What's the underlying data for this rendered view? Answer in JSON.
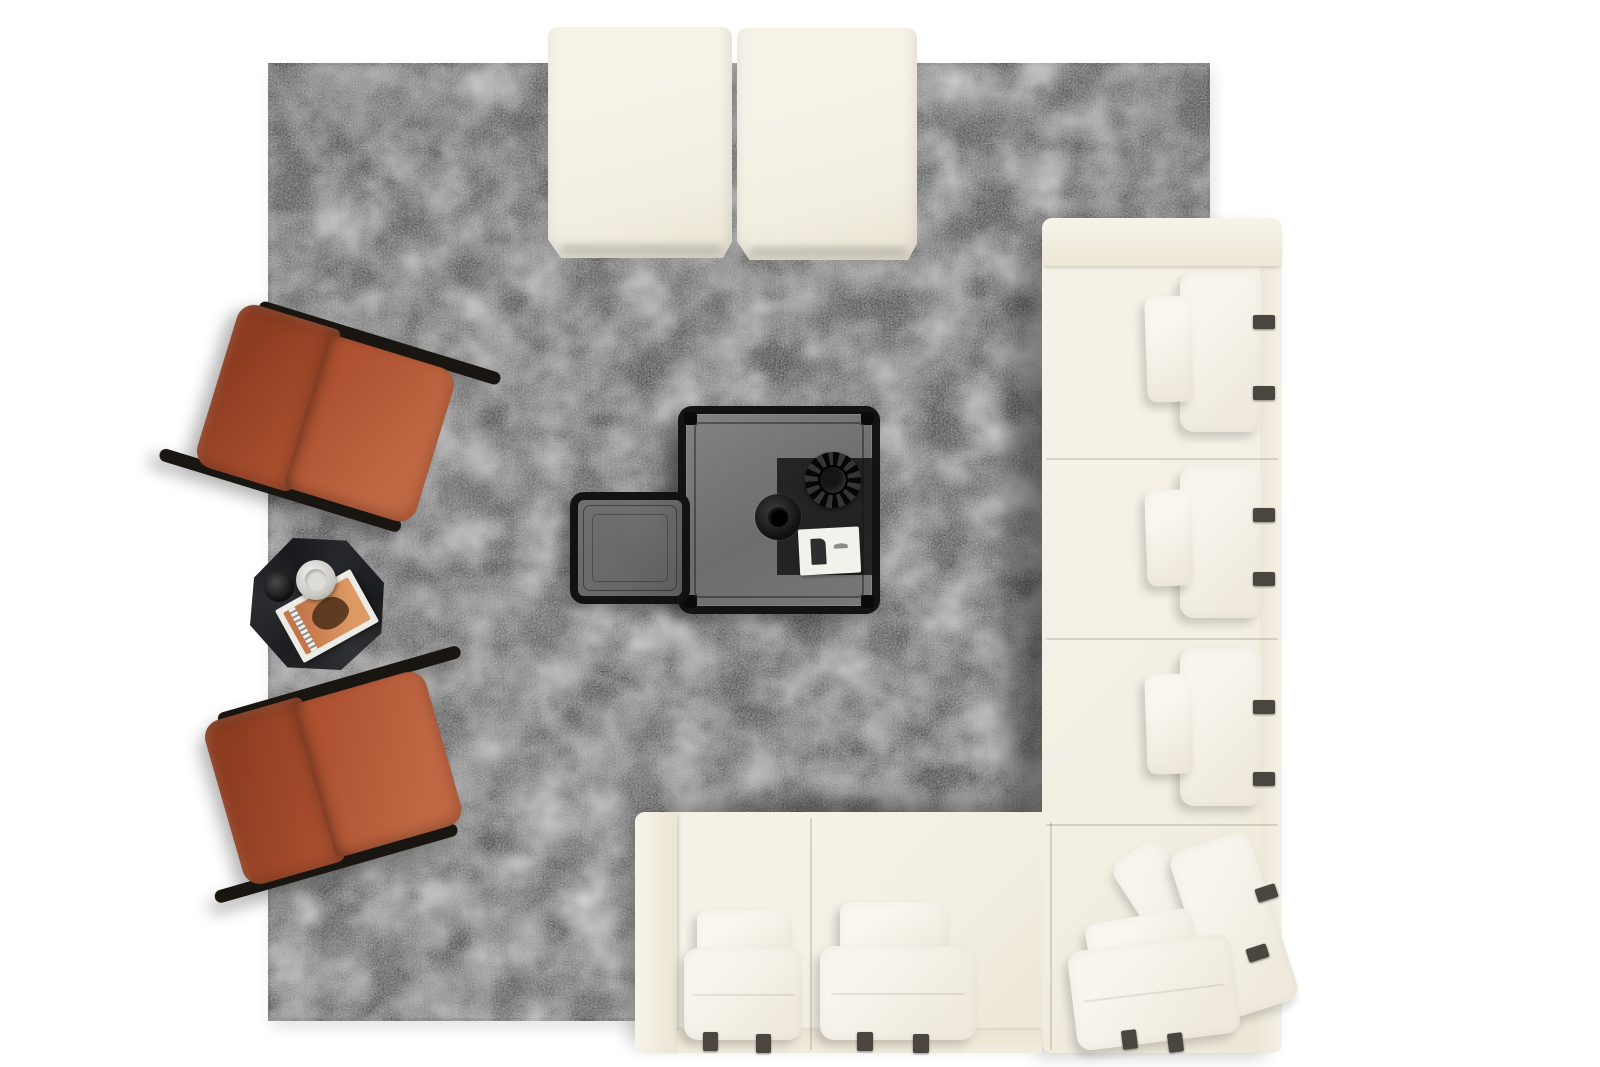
{
  "scene": {
    "kind": "top-down photograph",
    "description": "Bird's-eye view of a living room furniture arrangement on a large square gray suede rug over a white floor"
  },
  "palette": {
    "bg": "#ffffff",
    "rug-base": "#757575",
    "rug-edge": "#4c4c4c",
    "cream": "#f2eee2",
    "pillow-hi": "#f8f5ee",
    "strap": "#4a463f",
    "rust": "#ad5130",
    "rust-dark": "#8c3c20",
    "rust-light": "#bf6743",
    "frame-black": "#191511",
    "table-black": "#131313",
    "glass": "#747474",
    "runner": "#1c1c1c",
    "card": "#f3f1ec",
    "magazine": "#c4764a"
  },
  "objects": {
    "rug": {
      "label": "large square charcoal-gray mottled rug"
    },
    "ottomans": {
      "label": "cream square ottomans at top edge",
      "count": 2
    },
    "sectional_sofa": {
      "label": "cream modular L-shaped sectional",
      "right_seat_modules": 3,
      "corner_modules": 1,
      "bottom_seat_modules": 2,
      "armrests": 2,
      "back_pillows_per_module": 2,
      "dark_straps_per_back_pillow": 2,
      "seat_pillow_straps_per_bottom_module": 2
    },
    "accent_chairs": {
      "label": "rust chenille lounge chairs with black frame rails",
      "count": 2
    },
    "coffee_table": {
      "label": "black square smoked-glass coffee table",
      "decor": [
        "dark table runner",
        "round black bowl",
        "black fluted vase",
        "white booklet"
      ]
    },
    "nesting_table": {
      "label": "small black glass nesting table beside coffee table"
    },
    "side_table": {
      "label": "black faceted octagonal side table",
      "decor": [
        "glass cup",
        "small black bowl",
        "magazine stack with orange cover"
      ]
    }
  }
}
